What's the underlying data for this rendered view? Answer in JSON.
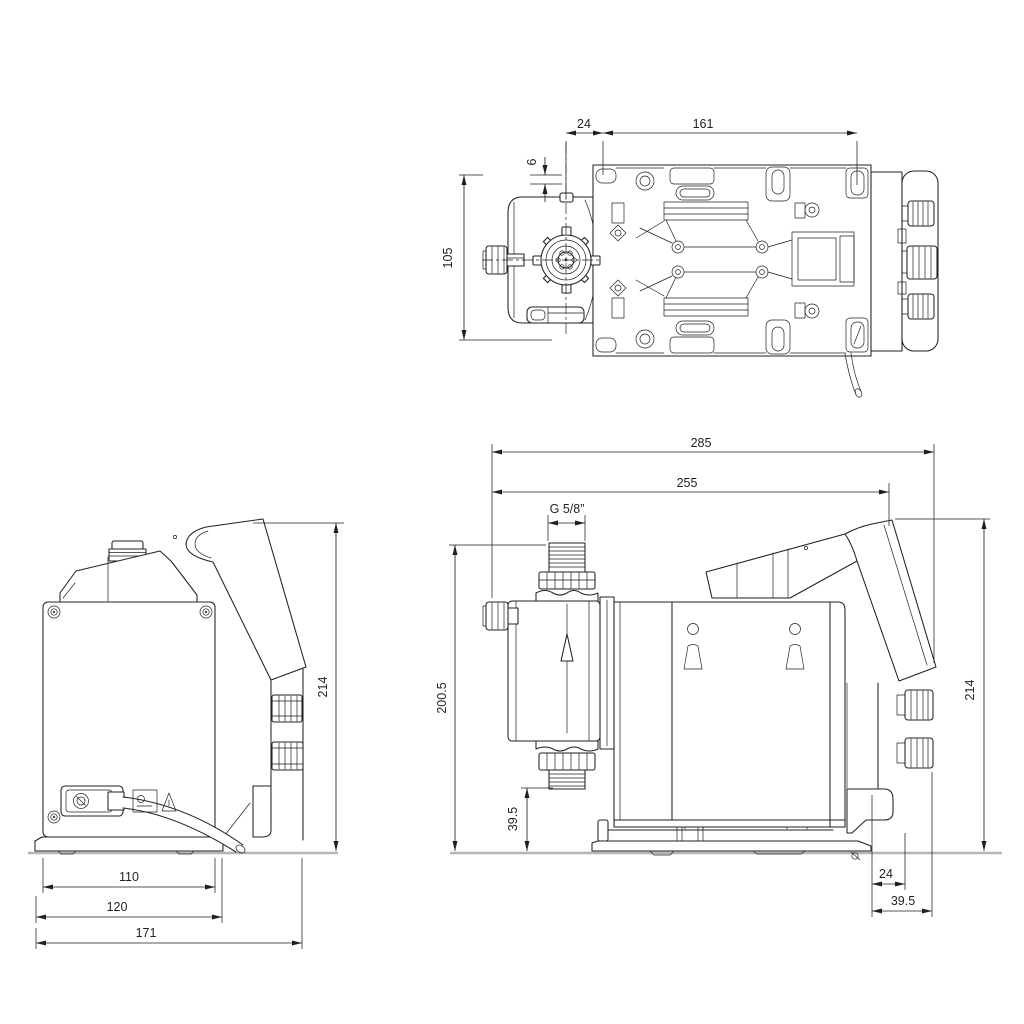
{
  "document": {
    "type": "Technical dimensional drawing",
    "subject": "Diaphragm dosing pump - three orthographic views",
    "units": "mm",
    "background_color": "#ffffff",
    "line_color": "#231f20",
    "ground_line_color": "#b3b5b8"
  },
  "views": {
    "top": {
      "name": "top view",
      "dimensions": {
        "valve_center_to_hole": "24",
        "mounting_hole_span": "161",
        "edge_offset": "6",
        "housing_width": "105"
      }
    },
    "back": {
      "name": "back view",
      "dimensions": {
        "overall_height": "214",
        "plate_width": "110",
        "base_width": "120",
        "overall_width": "171"
      }
    },
    "side": {
      "name": "side view",
      "connection_thread": "G 5/8”",
      "dimensions": {
        "overall_depth": "285",
        "depth_to_control_panel": "255",
        "discharge_valve_height": "200.5",
        "suction_valve_height": "39.5",
        "overall_height": "214",
        "base_to_connector": "24",
        "base_to_rear": "39.5"
      }
    }
  }
}
